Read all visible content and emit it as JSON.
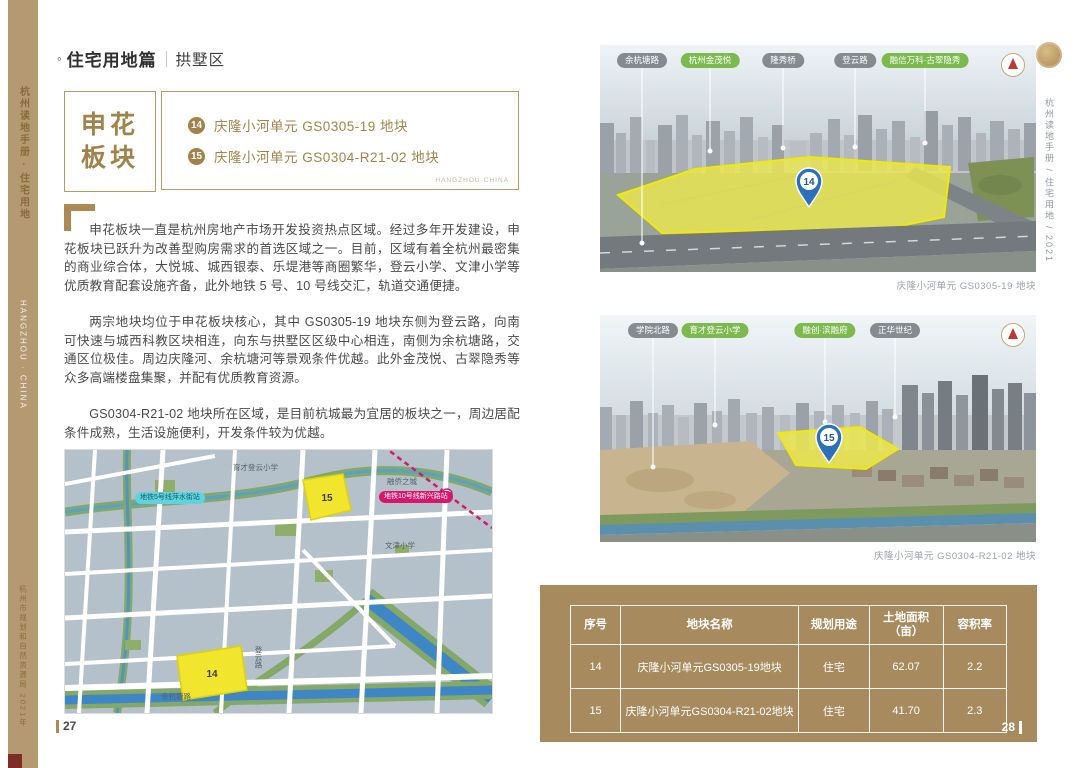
{
  "colors": {
    "gold_text": "#a0834a",
    "gold_border": "#b59a6e",
    "spine_tan": "#b49a71",
    "panel_tan": "#a78a5e",
    "plot_yellow": "#f2e52e",
    "marker_blue": "#2a71b8",
    "pill_green": "#7cb94e",
    "pill_gray": "#686f75",
    "metro5_cyan": "#62d3de",
    "metro10_magenta": "#d6176c"
  },
  "spine": {
    "top_vertical": "杭州读地手册 · 住宅用地",
    "middle_vertical": "HANGZHOU · CHINA",
    "bottom_vertical": "杭州市规划和自然资源局 2021年"
  },
  "left_page": {
    "title": {
      "bullet": "◦",
      "section": "住宅用地篇",
      "district": "拱墅区"
    },
    "plate": {
      "line1": "申花",
      "line2": "板块"
    },
    "plot_list": {
      "items": [
        {
          "no": "14",
          "name": "庆隆小河单元 GS0305-19 地块"
        },
        {
          "no": "15",
          "name": "庆隆小河单元 GS0304-R21-02 地块"
        }
      ],
      "watermark": "HANGZHOU·CHINA"
    },
    "paragraphs": {
      "p1": "申花板块一直是杭州房地产市场开发投资热点区域。经过多年开发建设，申花板块已跃升为改善型购房需求的首选区域之一。目前，区域有着全杭州最密集的商业综合体，大悦城、城西银泰、乐堤港等商圈繁华，登云小学、文津小学等优质教育配套设施齐备，此外地铁 5 号、10 号线交汇，轨道交通便捷。",
      "p2": "两宗地块均位于申花板块核心，其中 GS0305-19 地块东侧为登云路，向南可快速与城西科教区块相连，向东与拱墅区区级中心相连，南侧为余杭塘路，交通区位极佳。周边庆隆河、余杭塘河等景观条件优越。此外金茂悦、古翠隐秀等众多高端楼盘集聚，并配有优质教育资源。",
      "p3": "GS0304-R21-02 地块所在区域，是目前杭城最为宜居的板块之一，周边居配条件成熟，生活设施便利，开发条件较为优越。"
    },
    "map": {
      "metro5_label": "地铁5号线萍水街站",
      "metro10_label": "地铁10号线新兴路站",
      "plot14": "14",
      "plot15": "15",
      "labels": {
        "school_top": "育才登云小学",
        "rongqiao": "融侨之城",
        "wenjin": "文津小学",
        "yuhangtang": "余杭塘路",
        "dengyun": "登云路"
      }
    },
    "page_number": "27"
  },
  "right_page": {
    "photo1": {
      "pills": [
        {
          "label": "余杭塘路"
        },
        {
          "label": "杭州金茂悦"
        },
        {
          "label": "隆秀桥"
        },
        {
          "label": "登云路"
        },
        {
          "label": "融信万科·古翠隐秀"
        }
      ],
      "marker": "14",
      "caption": "庆隆小河单元 GS0305-19 地块"
    },
    "photo2": {
      "pills": [
        {
          "label": "学院北路"
        },
        {
          "label": "育才登云小学"
        },
        {
          "label": "融创·滨融府"
        },
        {
          "label": "正华世纪"
        }
      ],
      "marker": "15",
      "caption": "庆隆小河单元 GS0304-R21-02 地块"
    },
    "edge_vertical": "杭州读地手册 / 住宅用地 / 2021",
    "table": {
      "headers": [
        "序号",
        "地块名称",
        "规划用途",
        "土地面积",
        "容积率"
      ],
      "area_unit": "（亩）",
      "rows": [
        {
          "no": "14",
          "name": "庆隆小河单元GS0305-19地块",
          "use": "住宅",
          "area": "62.07",
          "far": "2.2"
        },
        {
          "no": "15",
          "name": "庆隆小河单元GS0304-R21-02地块",
          "use": "住宅",
          "area": "41.70",
          "far": "2.3"
        }
      ]
    },
    "page_number": "28"
  }
}
